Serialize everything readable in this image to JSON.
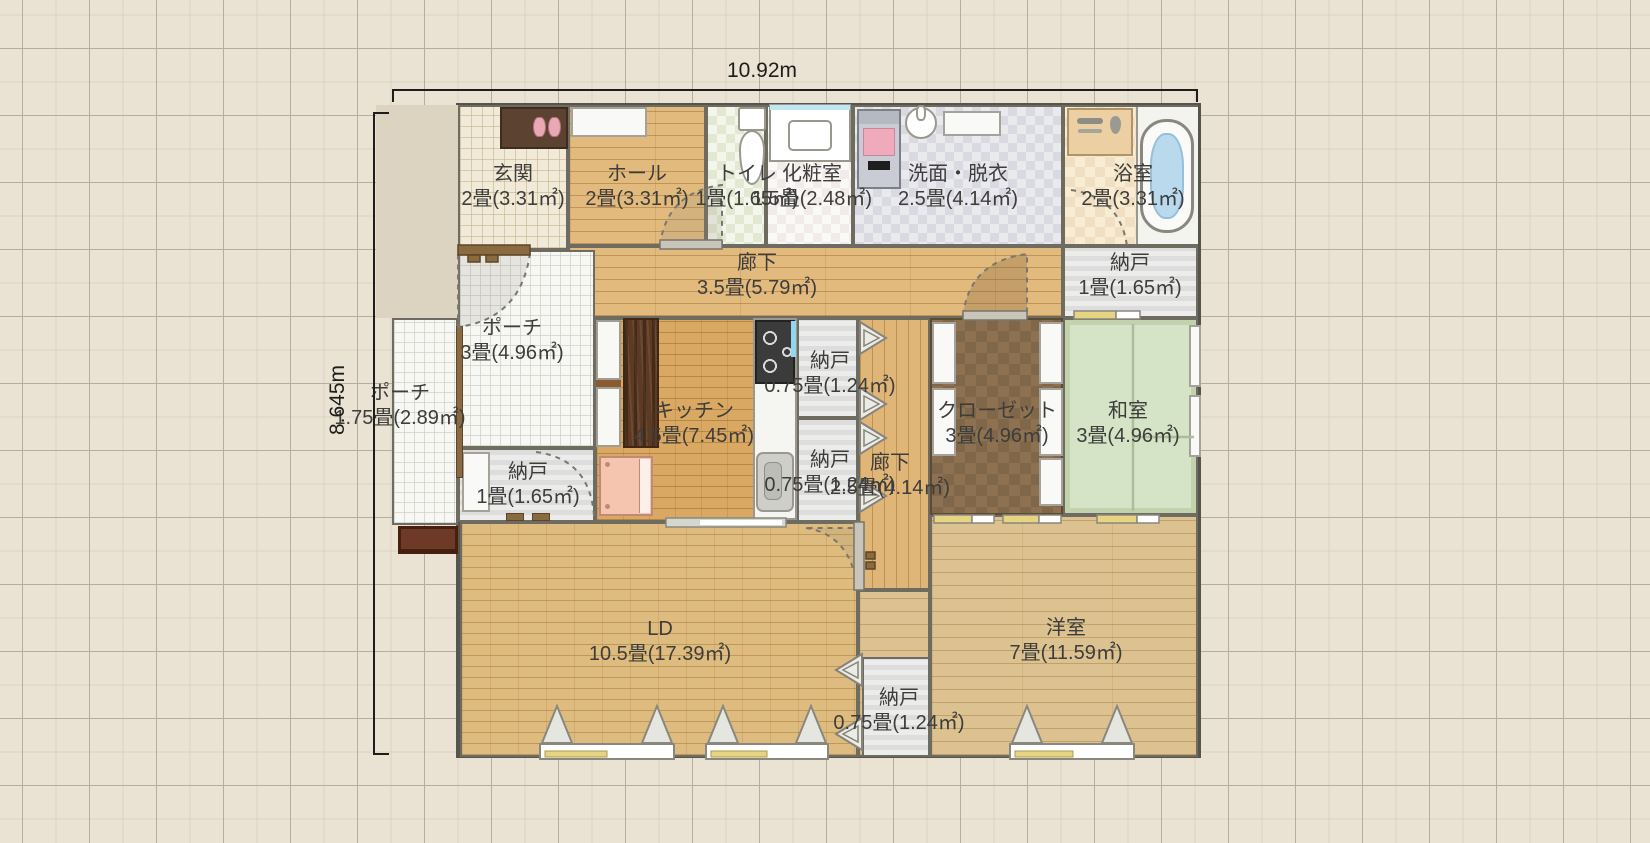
{
  "dimensions": {
    "width_label": "10.92m",
    "height_label": "8.645m"
  },
  "colors": {
    "canvas_bg": "#eae2d2",
    "wall": "#56544c",
    "wood_floor": "#e2ba7e",
    "ld_floor": "#debb7e",
    "tatami": "#d5e3c6",
    "closet_floor": "#8d7150",
    "storage_floor": "#e5e5e4",
    "porch_tile": "#f7f7f4",
    "bathtub_water": "#b9d9ec",
    "slider_yellow": "#e6d483",
    "dimension_line": "#1d1d1b"
  },
  "rooms": [
    {
      "id": "genkan",
      "name": "玄関",
      "size": "2畳(3.31㎡)",
      "floor": "tile",
      "rect": [
        458,
        105,
        110,
        145
      ],
      "label": [
        513,
        187
      ]
    },
    {
      "id": "hall",
      "name": "ホール",
      "size": "2畳(3.31㎡)",
      "floor": "wood",
      "rect": [
        568,
        105,
        138,
        141
      ],
      "label": [
        637,
        187
      ]
    },
    {
      "id": "toilet",
      "name": "トイレ",
      "size": "1畳(1.65㎡)",
      "floor": "checker-green",
      "rect": [
        706,
        105,
        60,
        141
      ],
      "label": [
        747,
        187
      ]
    },
    {
      "id": "powder-room",
      "name": "化粧室",
      "size": "1.5畳(2.48㎡)",
      "floor": "checker-white",
      "rect": [
        766,
        105,
        87,
        141
      ],
      "label": [
        812,
        187
      ]
    },
    {
      "id": "laundry",
      "name": "洗面・脱衣",
      "size": "2.5畳(4.14㎡)",
      "floor": "checker-gray",
      "rect": [
        853,
        105,
        210,
        141
      ],
      "label": [
        958,
        187
      ]
    },
    {
      "id": "bath",
      "name": "浴室",
      "size": "2畳(3.31㎡)",
      "floor": "bath",
      "rect": [
        1063,
        105,
        135,
        141
      ],
      "label": [
        1133,
        187
      ]
    },
    {
      "id": "corridor-north",
      "name": "廊下",
      "size": "3.5畳(5.79㎡)",
      "floor": "wood",
      "rect": [
        568,
        246,
        495,
        72
      ],
      "label": [
        757,
        276
      ]
    },
    {
      "id": "nando-northeast",
      "name": "納戸",
      "size": "1畳(1.65㎡)",
      "floor": "gray",
      "rect": [
        1063,
        246,
        135,
        72
      ],
      "label": [
        1130,
        276
      ]
    },
    {
      "id": "porch-3",
      "name": "ポーチ",
      "size": "3畳(4.96㎡)",
      "floor": "porch",
      "rect": [
        458,
        250,
        137,
        198
      ],
      "label": [
        512,
        341
      ]
    },
    {
      "id": "porch-175",
      "name": "ポーチ",
      "size": "1.75畳(2.89㎡)",
      "floor": "porch",
      "rect": [
        392,
        318,
        66,
        207
      ],
      "label": [
        400,
        406
      ]
    },
    {
      "id": "nando-porch",
      "name": "納戸",
      "size": "1畳(1.65㎡)",
      "floor": "gray",
      "rect": [
        458,
        448,
        137,
        74
      ],
      "label": [
        528,
        485
      ]
    },
    {
      "id": "kitchen",
      "name": "キッチン",
      "size": "4.5畳(7.45㎡)",
      "floor": "brick-k",
      "rect": [
        595,
        318,
        202,
        204
      ],
      "label": [
        694,
        424
      ]
    },
    {
      "id": "nando-a",
      "name": "納戸",
      "size": "0.75畳(1.24㎡)",
      "floor": "gray",
      "rect": [
        797,
        318,
        61,
        100
      ],
      "label": [
        830,
        374
      ]
    },
    {
      "id": "nando-b",
      "name": "納戸",
      "size": "0.75畳(1.24㎡)",
      "floor": "gray",
      "rect": [
        797,
        418,
        61,
        104
      ],
      "label": [
        830,
        473
      ]
    },
    {
      "id": "corridor-center",
      "name": "廊下",
      "size": "2.5畳(4.14㎡)",
      "floor": "wood-v",
      "rect": [
        858,
        318,
        72,
        272
      ],
      "label": [
        890,
        476
      ]
    },
    {
      "id": "closet",
      "name": "クローゼット",
      "size": "3畳(4.96㎡)",
      "floor": "closet",
      "rect": [
        930,
        318,
        133,
        197
      ],
      "label": [
        997,
        424
      ]
    },
    {
      "id": "washitsu",
      "name": "和室",
      "size": "3畳(4.96㎡)",
      "floor": "tatami",
      "rect": [
        1063,
        318,
        135,
        197
      ],
      "label": [
        1128,
        424
      ]
    },
    {
      "id": "yoshitsu-ext",
      "name": "",
      "size": "",
      "floor": "wood-light",
      "rect": [
        858,
        590,
        72,
        167
      ],
      "label": null
    },
    {
      "id": "ld",
      "name": "LD",
      "size": "10.5畳(17.39㎡)",
      "floor": "brick",
      "rect": [
        460,
        522,
        398,
        235
      ],
      "label": [
        660,
        642
      ]
    },
    {
      "id": "yoshitsu",
      "name": "洋室",
      "size": "7畳(11.59㎡)",
      "floor": "wood-light",
      "rect": [
        930,
        515,
        268,
        242
      ],
      "label": [
        1066,
        641
      ]
    },
    {
      "id": "nando-south",
      "name": "納戸",
      "size": "0.75畳(1.24㎡)",
      "floor": "gray",
      "rect": [
        862,
        657,
        68,
        100
      ],
      "label": [
        899,
        711
      ]
    }
  ],
  "fixtures": [
    {
      "type": "shoe-cabinet",
      "rect": [
        500,
        107,
        68,
        42
      ]
    },
    {
      "type": "slippers",
      "rect": [
        530,
        116,
        34,
        22
      ]
    },
    {
      "type": "hall-closet",
      "rect": [
        571,
        107,
        76,
        30
      ]
    },
    {
      "type": "toilet",
      "rect": [
        736,
        107,
        32,
        80
      ]
    },
    {
      "type": "vanity",
      "rect": [
        769,
        104,
        82,
        58
      ]
    },
    {
      "type": "washing-machine",
      "rect": [
        857,
        109,
        44,
        80
      ]
    },
    {
      "type": "wall-basin",
      "rect": [
        905,
        107,
        32,
        32
      ]
    },
    {
      "type": "bath-counter",
      "rect": [
        943,
        111,
        58,
        25
      ]
    },
    {
      "type": "shower-panel",
      "rect": [
        1067,
        108,
        66,
        48
      ]
    },
    {
      "type": "bath-floor",
      "rect": [
        1136,
        107,
        62,
        137
      ]
    },
    {
      "type": "bathtub",
      "rect": [
        1140,
        119,
        54,
        114
      ]
    },
    {
      "type": "kitchen-counter",
      "rect": [
        753,
        318,
        44,
        202
      ]
    },
    {
      "type": "stove",
      "rect": [
        755,
        320,
        40,
        64
      ]
    },
    {
      "type": "towel-bar",
      "rect": [
        791,
        321,
        5,
        36
      ]
    },
    {
      "type": "kitchen-sink",
      "rect": [
        756,
        452,
        38,
        60
      ]
    },
    {
      "type": "white-cabinet",
      "rect": [
        596,
        320,
        25,
        60
      ]
    },
    {
      "type": "cabinet-shelf",
      "rect": [
        596,
        380,
        25,
        7
      ]
    },
    {
      "type": "white-cabinet",
      "rect": [
        596,
        387,
        25,
        60
      ]
    },
    {
      "type": "walnut-cupboard",
      "rect": [
        623,
        318,
        36,
        130
      ]
    },
    {
      "type": "refrigerator",
      "rect": [
        599,
        456,
        54,
        60
      ]
    },
    {
      "type": "closet-panel",
      "rect": [
        932,
        322,
        24,
        62
      ]
    },
    {
      "type": "closet-panel",
      "rect": [
        932,
        388,
        24,
        68
      ]
    },
    {
      "type": "closet-panel",
      "rect": [
        1039,
        322,
        24,
        62
      ]
    },
    {
      "type": "closet-panel",
      "rect": [
        1039,
        388,
        24,
        68
      ]
    },
    {
      "type": "closet-panel",
      "rect": [
        1039,
        458,
        24,
        48
      ]
    },
    {
      "type": "storage-door",
      "rect": [
        462,
        452,
        28,
        60
      ]
    },
    {
      "type": "doormat",
      "rect": [
        398,
        526,
        60,
        28
      ]
    },
    {
      "type": "porch-post",
      "rect": [
        456,
        326,
        7,
        152
      ]
    },
    {
      "type": "door-sill",
      "rect": [
        506,
        513,
        18,
        8
      ]
    },
    {
      "type": "door-sill",
      "rect": [
        532,
        513,
        18,
        8
      ]
    },
    {
      "type": "window-vertical",
      "rect": [
        1189,
        325,
        12,
        62
      ]
    },
    {
      "type": "window-vertical",
      "rect": [
        1189,
        395,
        12,
        62
      ]
    }
  ]
}
